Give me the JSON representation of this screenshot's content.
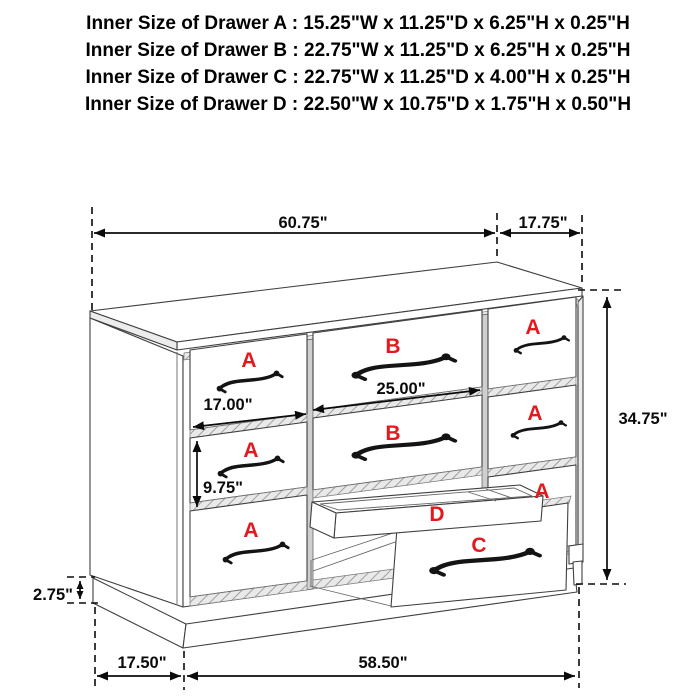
{
  "header": {
    "lines": [
      "Inner Size of Drawer A : 15.25\"W x 11.25\"D x 6.25\"H x 0.25\"H",
      "Inner Size of Drawer B : 22.75\"W x 11.25\"D x 6.25\"H x 0.25\"H",
      "Inner Size of Drawer C : 22.75\"W x 11.25\"D x 4.00\"H x 0.25\"H",
      "Inner Size of Drawer  D : 22.50\"W x 10.75\"D x 1.75\"H x 0.50\"H"
    ]
  },
  "diagram": {
    "dimensions": {
      "top_width": "60.75\"",
      "top_depth": "17.75\"",
      "overall_height": "34.75\"",
      "drawer_a_width": "17.00\"",
      "drawer_b_width": "25.00\"",
      "drawer_a_height": "9.75\"",
      "base_height": "2.75\"",
      "base_side_depth": "17.50\"",
      "base_front_width": "58.50\""
    },
    "drawer_labels": {
      "left_top": "A",
      "left_middle": "A",
      "left_bottom": "A",
      "middle_top": "B",
      "middle_middle": "B",
      "right_top": "A",
      "right_middle": "A",
      "right_bottom": "A",
      "hidden_tray": "D",
      "open_drawer": "C"
    },
    "colors": {
      "label": "#e2191d",
      "line": "#3f3f3f",
      "dimension": "#0b0b0b"
    }
  }
}
